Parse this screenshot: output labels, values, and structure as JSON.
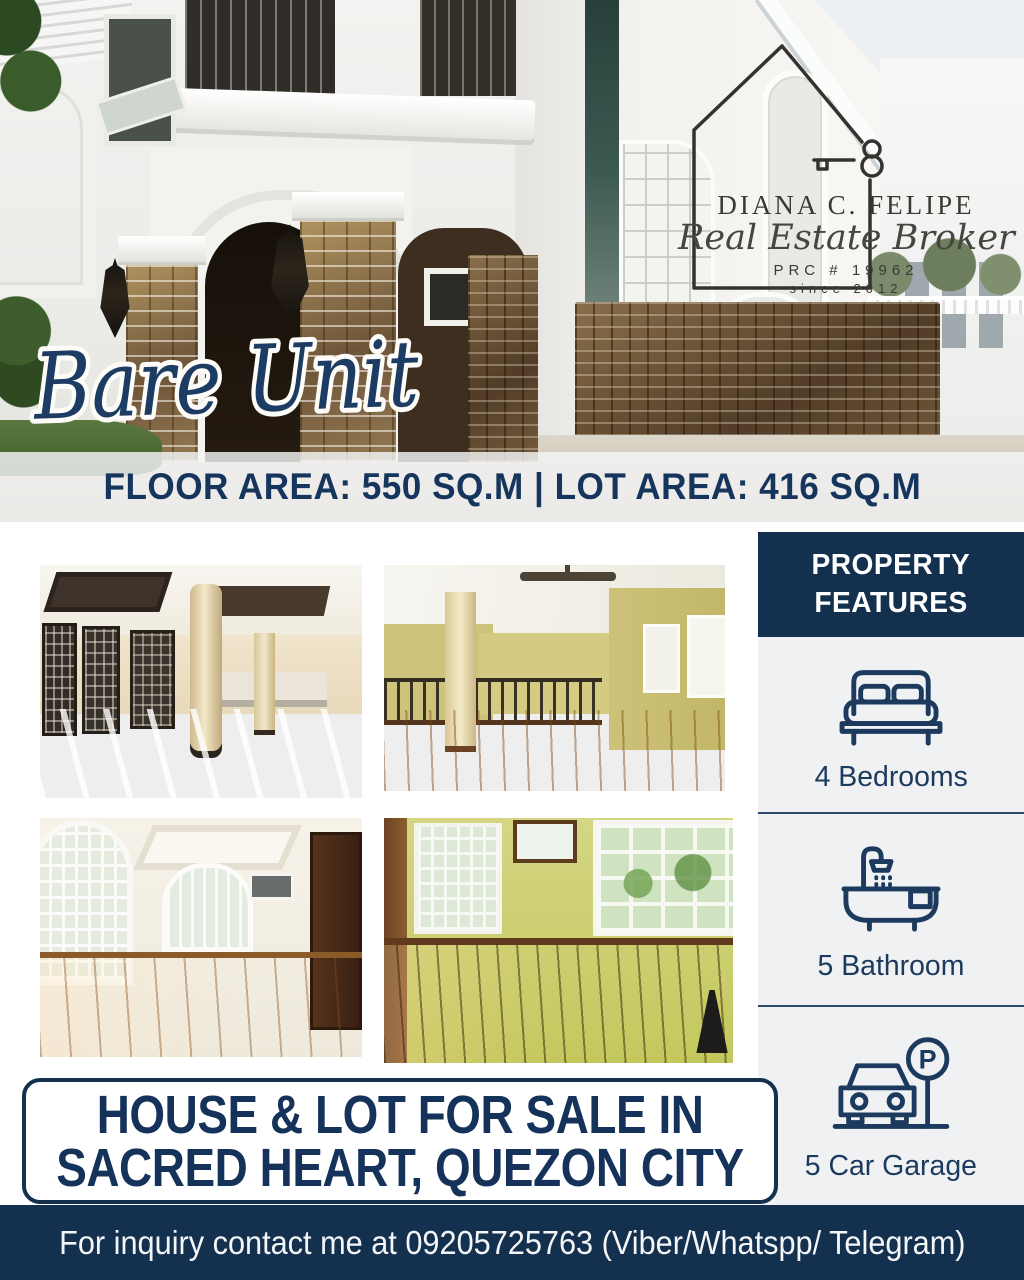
{
  "brand": {
    "name": "DIANA C. FELIPE",
    "tagline": "Real Estate Broker",
    "license": "PRC # 19962",
    "since": "since 2012"
  },
  "hero": {
    "script_label": "Bare Unit",
    "area_banner": "FLOOR AREA: 550 SQ.M | LOT AREA: 416 SQ.M"
  },
  "features": {
    "header_line1": "PROPERTY",
    "header_line2": "FEATURES",
    "items": [
      {
        "icon": "bed-icon",
        "label": "4 Bedrooms"
      },
      {
        "icon": "bathtub-icon",
        "label": "5 Bathroom"
      },
      {
        "icon": "car-parking-icon",
        "label": "5 Car Garage"
      }
    ]
  },
  "headline": {
    "line1": "HOUSE & LOT FOR SALE IN",
    "line2": "SACRED HEART, QUEZON CITY"
  },
  "footer": {
    "contact": "For inquiry contact me at 09205725763 (Viber/Whatspp/ Telegram)"
  },
  "photos": {
    "hero": "house-exterior-photo",
    "grid": [
      "living-area-photo",
      "loft-hall-photo",
      "bedroom-photo",
      "green-room-photo"
    ]
  },
  "colors": {
    "navy": "#14304f",
    "text_navy": "#16355d",
    "sidebar_bg": "#f0f1f3",
    "banner_overlay": "rgba(244,245,247,0.82)"
  }
}
